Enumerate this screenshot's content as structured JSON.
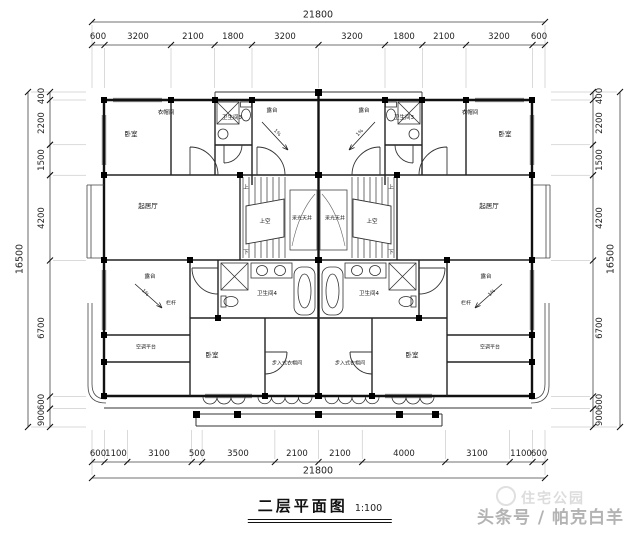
{
  "drawing": {
    "title": "二层平面图",
    "scale": "1:100"
  },
  "watermark": {
    "brand": "住宅公园",
    "credit": "头条号 / 帕克白羊"
  },
  "dimensions": {
    "top": {
      "total": "21800",
      "segments": [
        "600",
        "3200",
        "2100",
        "1800",
        "3200",
        "3200",
        "1800",
        "2100",
        "3200",
        "600"
      ]
    },
    "bottom": {
      "total": "21800",
      "segments": [
        "600",
        "1100",
        "3100",
        "500",
        "3500",
        "2100",
        "2100",
        "4000",
        "3100",
        "1100",
        "600"
      ]
    },
    "left": {
      "total": "16500",
      "segments": [
        "400",
        "2200",
        "1500",
        "4200",
        "6700",
        "600",
        "900"
      ]
    },
    "right": {
      "total": "16500",
      "segments": [
        "400",
        "2200",
        "1500",
        "4200",
        "6700",
        "600",
        "900"
      ]
    }
  },
  "rooms": {
    "bedroom": "卧室",
    "closet": "衣帽间",
    "bath3": "卫生间3",
    "bath4": "卫生间4",
    "terrace": "露台",
    "living": "起居厅",
    "walk_in_closet": "步入式衣帽间",
    "ac_platform": "空调平台",
    "railing": "栏杆",
    "light_well": "采光天井",
    "void_above": "上空",
    "up": "上",
    "down": "下",
    "slope": "1%"
  }
}
